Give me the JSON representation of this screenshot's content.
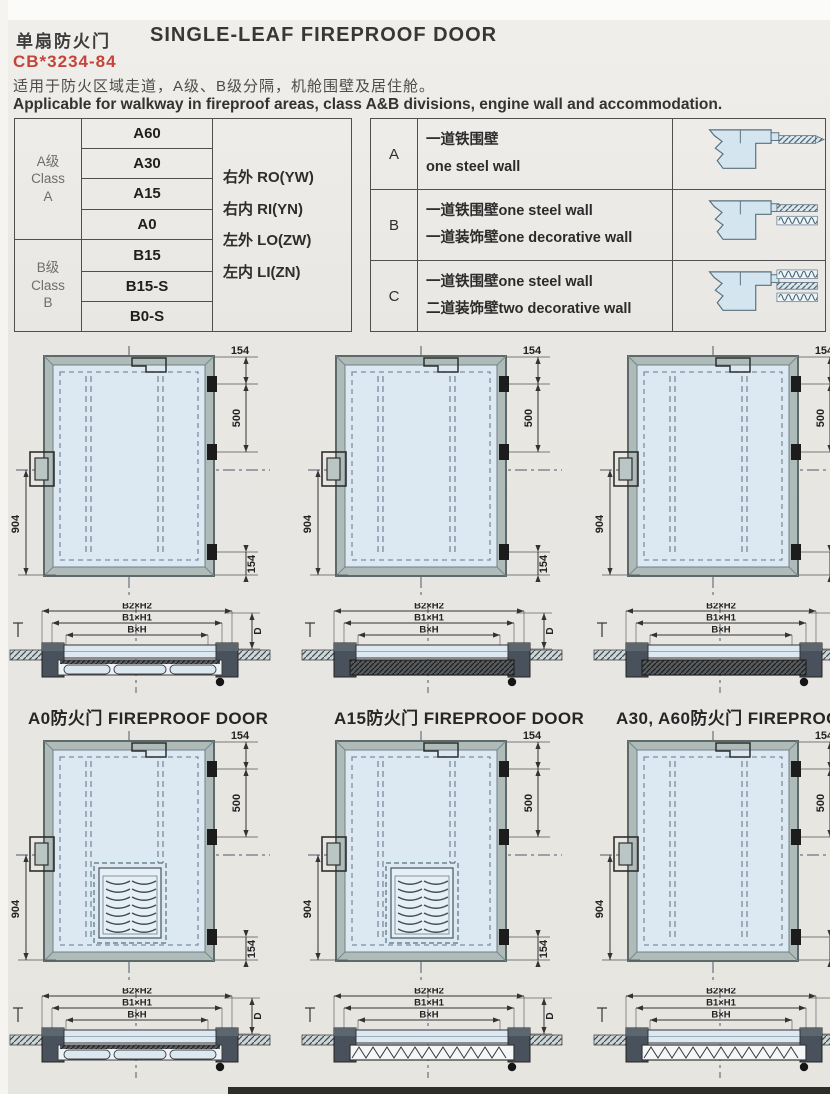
{
  "page": {
    "title_cn": "单扇防火门",
    "title_en": "SINGLE-LEAF FIREPROOF DOOR",
    "standard_code": "CB*3234-84",
    "desc_cn": "适用于防火区域走道，A级、B级分隔，机舱围壁及居住舱。",
    "desc_en": "Applicable for walkway in fireproof areas, class A&B divisions, engine wall and accommodation.",
    "colors": {
      "accent_red": "#c5443a",
      "door_fill": "#dce9f3",
      "frame_fill": "#aebbb9",
      "dash_line": "#4a5a6a",
      "ink": "#2b2b2b",
      "diagram_blue": "#d5e5f0"
    }
  },
  "class_table": {
    "groups": [
      {
        "label_lines": [
          "A级",
          "Class",
          "A"
        ],
        "ratings": [
          "A60",
          "A30",
          "A15",
          "A0"
        ]
      },
      {
        "label_lines": [
          "B级",
          "Class",
          "B"
        ],
        "ratings": [
          "B15",
          "B15-S",
          "B0-S"
        ]
      }
    ],
    "orientations": [
      "右外 RO(YW)",
      "右内 RI(YN)",
      "左外 LO(ZW)",
      "左内 LI(ZN)"
    ]
  },
  "wall_table": {
    "rows": [
      {
        "key": "A",
        "lines": [
          "一道铁围壁",
          "one steel wall"
        ],
        "walls": 1
      },
      {
        "key": "B",
        "lines": [
          "一道铁围壁one steel wall",
          "一道装饰壁one decorative wall"
        ],
        "walls": 2
      },
      {
        "key": "C",
        "lines": [
          "一道铁围壁one steel wall",
          "二道装饰壁two decorative wall"
        ],
        "walls": 3
      }
    ]
  },
  "panels": [
    {
      "caption": "A0防火门 FIREPROOF DOOR",
      "louver": false,
      "leaf": "pills",
      "dims": {
        "top": "154",
        "upper": "500",
        "left": "904",
        "bottom": "154"
      },
      "section_labels": {
        "outer": "B2×H2",
        "middle": "B1×H1",
        "inner": "B×H",
        "depth": "D"
      }
    },
    {
      "caption": "A15防火门 FIREPROOF DOOR",
      "louver": false,
      "leaf": "hatch",
      "dims": {
        "top": "154",
        "upper": "500",
        "left": "904",
        "bottom": "154"
      },
      "section_labels": {
        "outer": "B2×H2",
        "middle": "B1×H1",
        "inner": "B×H",
        "depth": "D"
      }
    },
    {
      "caption": "A30, A60防火门 FIREPROOF DOOR",
      "louver": false,
      "leaf": "hatch",
      "dims": {
        "top": "154",
        "upper": "500",
        "left": "904",
        "bottom": "154"
      },
      "section_labels": {
        "outer": "B2×H2",
        "middle": "B1×H1",
        "inner": "B×H",
        "depth": "D"
      }
    },
    {
      "caption": "B0S级防火门 FIREPROOF DOOR",
      "louver": true,
      "leaf": "pills",
      "dims": {
        "top": "154",
        "upper": "500",
        "left": "904",
        "bottom": "154"
      },
      "section_labels": {
        "outer": "B2×H2",
        "middle": "B1×H1",
        "inner": "B×H",
        "depth": "D"
      }
    },
    {
      "caption": "B15S防火门 FIREPROOF DOOR",
      "louver": true,
      "leaf": "zigzag",
      "dims": {
        "top": "154",
        "upper": "500",
        "left": "904",
        "bottom": "154"
      },
      "section_labels": {
        "outer": "B2×H2",
        "middle": "B1×H1",
        "inner": "B×H",
        "depth": "D"
      }
    },
    {
      "caption": "B15级防火门FIREPROOF DOOR",
      "louver": false,
      "leaf": "zigzag",
      "dims": {
        "top": "154",
        "upper": "500",
        "left": "904",
        "bottom": "154"
      },
      "section_labels": {
        "outer": "B2×H2",
        "middle": "B1×H1",
        "inner": "B×H",
        "depth": "D"
      }
    }
  ]
}
